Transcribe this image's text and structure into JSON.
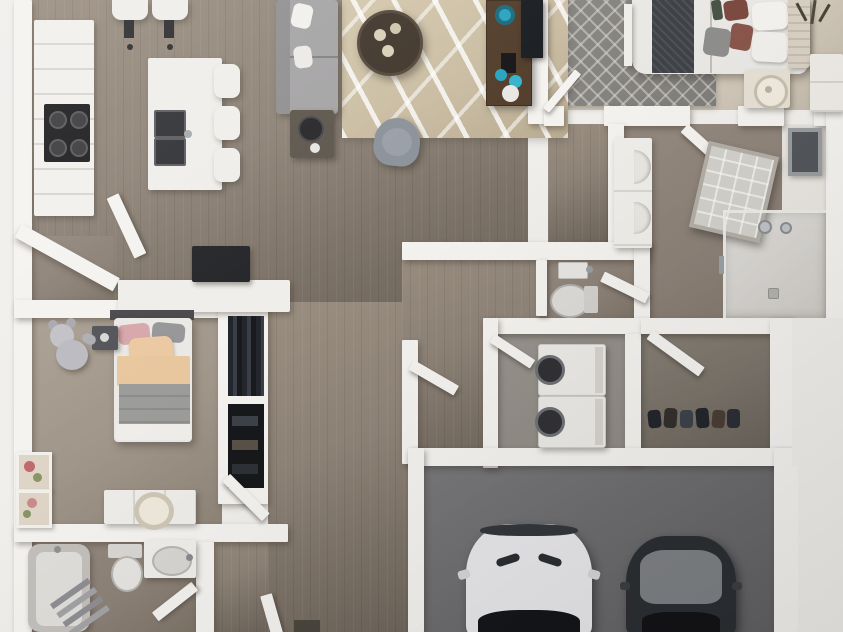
{
  "scene": {
    "description": "3D top-down floor plan render of a two-bedroom, two-bath apartment with kitchen island, open living room, laundry room, walk-in closets and an attached two-car garage",
    "canvas_width": 843,
    "canvas_height": 632,
    "visible_text": "none"
  },
  "palette": {
    "wall": "#f5f3f0",
    "wood": "#8f8478",
    "wood_light": "#9a8e80",
    "wood_dark": "#6f665c",
    "carpet_master": "#d2c9ba",
    "rug_master": "#807e7a",
    "rug_living": "#cabda3",
    "carpet_bed2": "#a1968a",
    "bath_floor": "#8c8177",
    "laundry_floor": "#8f8a84",
    "closet_dark_floor": "#7b746b",
    "garage_floor": "#6b6b6d",
    "sofa": "#a6a5a6",
    "coffee_table": "#42382e",
    "console_wood": "#543f2d",
    "accent_teal": "#2ba4bf",
    "tv": "#1b1e22",
    "bed_throw_charcoal": "#3f4247",
    "pillow_maroon": "#7c4a41",
    "headboard_beige": "#d8d0c3",
    "pillow_pink": "#d7a7ac",
    "pillow_peach": "#ebc9a1",
    "duvet_gray": "#9c9c9a",
    "teddy_gray": "#bbbbc1",
    "car_white": "#e9e9ec",
    "car_dark": "#2c2f33",
    "car_glass": "#141619",
    "car_hood_gray": "#7f8285",
    "appliance_white": "#eceae7",
    "appliance_door_dark": "#323236",
    "cavity": "#17181b",
    "lamp_cream": "#cfc7b6",
    "mirror_frame": "#b3afa7",
    "mirror_glass": "#d3d1cc",
    "art_red": "#bf6a6f",
    "art_green": "#8a9465"
  },
  "rooms": [
    {
      "id": "kitchen",
      "features": [
        "l-shaped-counter",
        "cooktop",
        "island-double-sink",
        "island-stools x3",
        "bar-stools x2"
      ]
    },
    {
      "id": "living-room",
      "features": [
        "sectional-sofa",
        "white-pillows",
        "abstract-area-rug",
        "round-coffee-table",
        "accent-chair",
        "side-table-lamp",
        "media-console",
        "teal-decor",
        "wall-tv"
      ]
    },
    {
      "id": "master-bedroom",
      "features": [
        "bed",
        "charcoal-throw",
        "maroon-pillows",
        "tufted-headboard",
        "trellis-rug",
        "nightstand-lamp",
        "dresser",
        "dried-plant"
      ]
    },
    {
      "id": "master-bathroom",
      "features": [
        "walk-in-shower",
        "leaning-framed-mirror",
        "linen-shelf-towels",
        "open-door"
      ]
    },
    {
      "id": "walk-in-closet",
      "features": [
        "shelving",
        "hanging-garment"
      ]
    },
    {
      "id": "powder-room",
      "features": [
        "toilet",
        "small-sink",
        "open-door"
      ]
    },
    {
      "id": "laundry-room",
      "features": [
        "washer",
        "dryer",
        "open-door"
      ]
    },
    {
      "id": "shoe-closet",
      "features": [
        "shoe-row",
        "open-door"
      ]
    },
    {
      "id": "bedroom-2",
      "features": [
        "bed",
        "pink-peach-bedding",
        "teddy-bear",
        "nightstand",
        "dresser-lamp",
        "wall-art x2",
        "closet-cavities x2",
        "open-door"
      ]
    },
    {
      "id": "bathroom-2",
      "features": [
        "bathtub",
        "toilet",
        "vanity-sink",
        "towel-ladder",
        "open-door"
      ]
    },
    {
      "id": "garage",
      "features": [
        "white-car",
        "dark-gray-car"
      ]
    },
    {
      "id": "hallway",
      "features": [
        "front-door",
        "door-mat",
        "pantry-nook",
        "desk-with-monitor"
      ]
    }
  ],
  "counts": {
    "cars": 2,
    "beds": 2,
    "toilets": 2,
    "stools_island": 3,
    "stools_bar": 2
  }
}
